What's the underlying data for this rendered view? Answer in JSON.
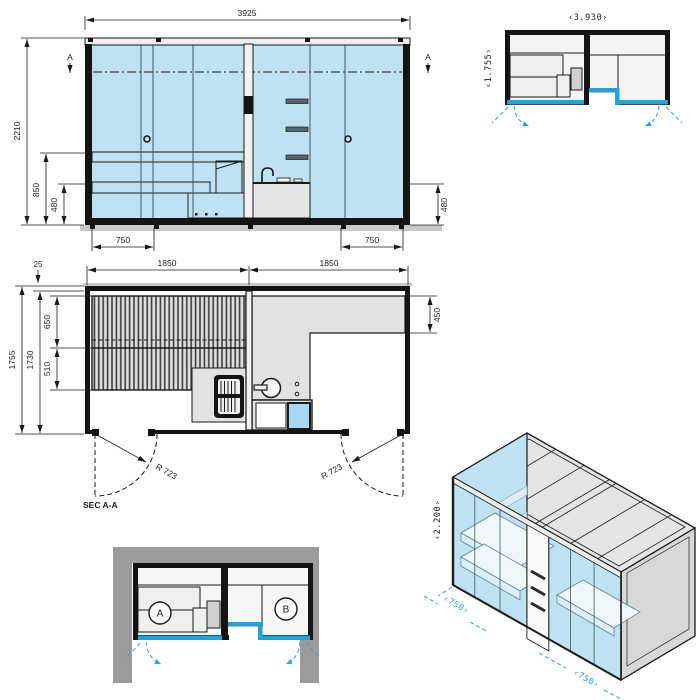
{
  "colors": {
    "glass_blue": "#bfe2f2",
    "accent_blue": "#2a9fd4",
    "line_dark": "#1a1a1a",
    "alcove_gray": "#9b9b9b",
    "panel_gray": "#e4e4e2"
  },
  "front_elevation": {
    "dim_total_width": "3925",
    "dim_total_height": "2210",
    "dim_bench_height": "850",
    "dim_seat_height_left": "480",
    "dim_seat_height_right": "480",
    "dim_door_width_left": "750",
    "dim_door_width_right": "750",
    "section_marker_left": "A",
    "section_marker_right": "A"
  },
  "floor_plan": {
    "dim_module_left": "1850",
    "dim_module_right": "1850",
    "dim_depth_total": "1755",
    "dim_depth_inner": "1730",
    "dim_wall_offset": "25",
    "dim_bench_depth_upper": "650",
    "dim_bench_depth_lower": "510",
    "dim_counter_depth": "450",
    "door_swing_left": "R 723",
    "door_swing_right": "R 723",
    "section_label": "SEC A-A"
  },
  "mini_plan": {
    "dim_width": "‹3.930›",
    "dim_depth": "‹1.755›"
  },
  "niche_diagram": {
    "room_a_label": "A",
    "room_b_label": "B"
  },
  "isometric": {
    "dim_height": "‹2.200›",
    "dim_door_left": "‹750›",
    "dim_door_right": "‹750›"
  }
}
